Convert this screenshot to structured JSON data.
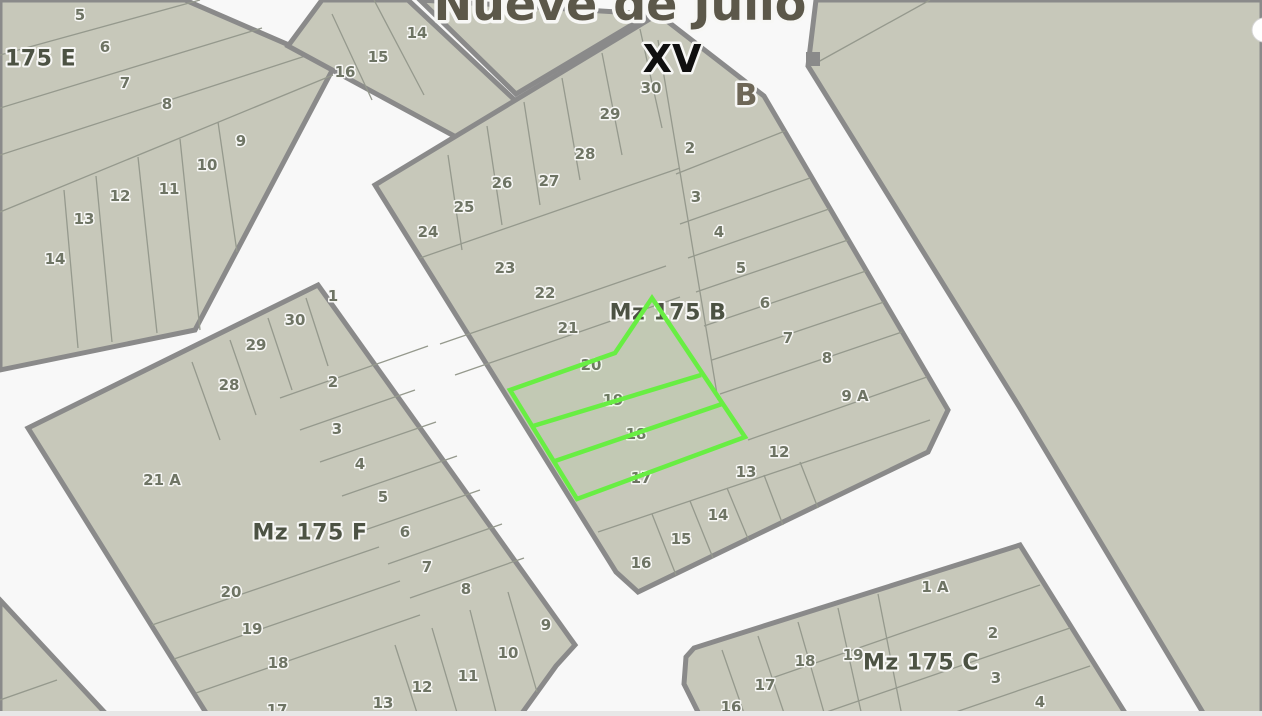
{
  "map": {
    "width": 1262,
    "height": 716,
    "road_color": "#f8f8f8",
    "block_fill": "#c7c8ba",
    "block_border": "#8a8a8a",
    "parcel_line_color": "#95998d",
    "number_color": "#6e7464",
    "label_color": "#4c5243",
    "halo_color": "#f7f7f5",
    "highlight_color": "#68ee43",
    "bottom_strip_color": "#e7e7e7"
  },
  "street_title": {
    "text": "Nueve de Julio",
    "x": 620,
    "y": 20,
    "size": 46,
    "color": "#5c584a"
  },
  "section_label": {
    "text": "XV",
    "x": 672,
    "y": 72,
    "size": 38,
    "color": "#0f0f0f"
  },
  "street_letter": {
    "text": "B",
    "x": 746,
    "y": 105,
    "size": 30,
    "color": "#6e6757"
  },
  "blocks": [
    {
      "id": "175-e",
      "label": "175 E",
      "label_x": 5,
      "label_y": 59,
      "label_anchor": "start",
      "points": [
        [
          0,
          0
        ],
        [
          185,
          0
        ],
        [
          335,
          65
        ],
        [
          195,
          330
        ],
        [
          0,
          370
        ]
      ],
      "lines": [
        [
          0,
          55,
          200,
          0
        ],
        [
          0,
          108,
          262,
          28
        ],
        [
          0,
          155,
          330,
          48
        ],
        [
          0,
          212,
          333,
          75
        ],
        [
          64,
          190,
          78,
          348
        ],
        [
          96,
          176,
          112,
          342
        ],
        [
          138,
          157,
          157,
          333
        ],
        [
          180,
          139,
          200,
          330
        ],
        [
          218,
          122,
          237,
          252
        ]
      ],
      "numbers": [
        [
          "5",
          80,
          15
        ],
        [
          "6",
          105,
          47
        ],
        [
          "7",
          125,
          83
        ],
        [
          "8",
          167,
          104
        ],
        [
          "9",
          241,
          141
        ],
        [
          "10",
          207,
          165
        ],
        [
          "11",
          169,
          189
        ],
        [
          "12",
          120,
          196
        ],
        [
          "13",
          84,
          219
        ],
        [
          "14",
          55,
          259
        ]
      ]
    },
    {
      "id": "north-center",
      "points": [
        [
          322,
          0
        ],
        [
          408,
          0
        ],
        [
          520,
          105
        ],
        [
          480,
          150
        ],
        [
          288,
          46
        ]
      ],
      "lines": [
        [
          332,
          14,
          372,
          100
        ],
        [
          374,
          0,
          424,
          95
        ]
      ],
      "numbers": [
        [
          "14",
          417,
          33
        ],
        [
          "15",
          378,
          57
        ],
        [
          "16",
          345,
          72
        ]
      ]
    },
    {
      "id": "north-sliver",
      "points": [
        [
          420,
          0
        ],
        [
          650,
          14
        ],
        [
          516,
          94
        ]
      ],
      "lines": [],
      "numbers": []
    },
    {
      "id": "mz-175-b",
      "label": "Mz 175 B",
      "label_x": 668,
      "label_y": 313,
      "points": [
        [
          658,
          14
        ],
        [
          764,
          96
        ],
        [
          948,
          410
        ],
        [
          928,
          452
        ],
        [
          638,
          592
        ],
        [
          616,
          572
        ],
        [
          375,
          185
        ]
      ],
      "lines": [
        [
          658,
          40,
          718,
          400
        ],
        [
          676,
          174,
          785,
          131
        ],
        [
          680,
          224,
          810,
          178
        ],
        [
          688,
          258,
          829,
          209
        ],
        [
          696,
          292,
          848,
          240
        ],
        [
          704,
          326,
          866,
          271
        ],
        [
          712,
          360,
          884,
          302
        ],
        [
          720,
          394,
          902,
          332
        ],
        [
          748,
          440,
          927,
          377
        ],
        [
          448,
          155,
          462,
          250
        ],
        [
          487,
          126,
          502,
          225
        ],
        [
          524,
          102,
          540,
          205
        ],
        [
          562,
          78,
          580,
          180
        ],
        [
          602,
          53,
          622,
          155
        ],
        [
          640,
          29,
          662,
          128
        ],
        [
          420,
          258,
          680,
          168
        ],
        [
          440,
          344,
          666,
          266
        ],
        [
          455,
          375,
          680,
          297
        ],
        [
          598,
          532,
          930,
          420
        ],
        [
          652,
          514,
          676,
          575
        ],
        [
          690,
          501,
          713,
          558
        ],
        [
          727,
          488,
          749,
          541
        ],
        [
          764,
          475,
          783,
          525
        ],
        [
          800,
          462,
          818,
          508
        ]
      ],
      "numbers": [
        [
          "30",
          651,
          88
        ],
        [
          "29",
          610,
          114
        ],
        [
          "28",
          585,
          154
        ],
        [
          "27",
          549,
          181
        ],
        [
          "26",
          502,
          183
        ],
        [
          "25",
          464,
          207
        ],
        [
          "24",
          428,
          232
        ],
        [
          "23",
          505,
          268
        ],
        [
          "22",
          545,
          293
        ],
        [
          "21",
          568,
          328
        ],
        [
          "20",
          591,
          365
        ],
        [
          "19",
          613,
          400
        ],
        [
          "18",
          636,
          434
        ],
        [
          "17",
          641,
          478
        ],
        [
          "16",
          641,
          563
        ],
        [
          "15",
          681,
          539
        ],
        [
          "14",
          718,
          515
        ],
        [
          "13",
          746,
          472
        ],
        [
          "12",
          779,
          452
        ],
        [
          "2",
          690,
          148
        ],
        [
          "3",
          696,
          197
        ],
        [
          "4",
          719,
          232
        ],
        [
          "5",
          741,
          268
        ],
        [
          "6",
          765,
          303
        ],
        [
          "7",
          788,
          338
        ],
        [
          "8",
          827,
          358
        ],
        [
          "9 A",
          855,
          396
        ]
      ]
    },
    {
      "id": "mz-175-f",
      "label": "Mz 175 F",
      "label_x": 310,
      "label_y": 533,
      "points": [
        [
          318,
          285
        ],
        [
          575,
          645
        ],
        [
          556,
          666
        ],
        [
          520,
          716
        ],
        [
          208,
          716
        ],
        [
          28,
          428
        ]
      ],
      "lines": [
        [
          306,
          298,
          328,
          366
        ],
        [
          268,
          318,
          292,
          390
        ],
        [
          230,
          340,
          256,
          415
        ],
        [
          192,
          362,
          220,
          440
        ],
        [
          280,
          398,
          428,
          346
        ],
        [
          300,
          430,
          415,
          390
        ],
        [
          320,
          462,
          436,
          422
        ],
        [
          342,
          496,
          457,
          456
        ],
        [
          365,
          530,
          480,
          490
        ],
        [
          388,
          564,
          502,
          524
        ],
        [
          410,
          598,
          524,
          558
        ],
        [
          152,
          625,
          379,
          547
        ],
        [
          174,
          659,
          400,
          581
        ],
        [
          196,
          693,
          420,
          615
        ],
        [
          395,
          645,
          418,
          716
        ],
        [
          432,
          628,
          458,
          716
        ],
        [
          470,
          610,
          497,
          716
        ],
        [
          508,
          592,
          537,
          692
        ]
      ],
      "numbers": [
        [
          "1",
          333,
          296
        ],
        [
          "30",
          295,
          320
        ],
        [
          "29",
          256,
          345
        ],
        [
          "28",
          229,
          385
        ],
        [
          "2",
          333,
          382
        ],
        [
          "3",
          337,
          429
        ],
        [
          "4",
          360,
          464
        ],
        [
          "5",
          383,
          497
        ],
        [
          "6",
          405,
          532
        ],
        [
          "7",
          427,
          567
        ],
        [
          "8",
          466,
          589
        ],
        [
          "9",
          546,
          625
        ],
        [
          "10",
          508,
          653
        ],
        [
          "11",
          468,
          676
        ],
        [
          "12",
          422,
          687
        ],
        [
          "13",
          383,
          703
        ],
        [
          "21 A",
          162,
          480
        ],
        [
          "20",
          231,
          592
        ],
        [
          "19",
          252,
          629
        ],
        [
          "18",
          278,
          663
        ],
        [
          "17",
          277,
          710
        ]
      ]
    },
    {
      "id": "mz-175-c",
      "label": "Mz 175 C",
      "label_x": 921,
      "label_y": 663,
      "points": [
        [
          1020,
          545
        ],
        [
          1127,
          716
        ],
        [
          700,
          716
        ],
        [
          684,
          684
        ],
        [
          686,
          657
        ],
        [
          694,
          648
        ]
      ],
      "lines": [
        [
          772,
          678,
          1040,
          585
        ],
        [
          815,
          716,
          1070,
          628
        ],
        [
          950,
          714,
          1090,
          666
        ],
        [
          722,
          650,
          745,
          716
        ],
        [
          758,
          636,
          785,
          716
        ],
        [
          798,
          622,
          825,
          716
        ],
        [
          838,
          608,
          862,
          716
        ],
        [
          878,
          594,
          902,
          716
        ]
      ],
      "numbers": [
        [
          "1 A",
          935,
          587
        ],
        [
          "2",
          993,
          633
        ],
        [
          "3",
          996,
          678
        ],
        [
          "4",
          1040,
          702
        ],
        [
          "19",
          853,
          655
        ],
        [
          "18",
          805,
          661
        ],
        [
          "17",
          765,
          685
        ],
        [
          "16",
          731,
          707
        ]
      ]
    },
    {
      "id": "east-large",
      "points": [
        [
          816,
          0
        ],
        [
          1262,
          0
        ],
        [
          1262,
          716
        ],
        [
          1205,
          716
        ],
        [
          1020,
          408
        ],
        [
          808,
          66
        ]
      ],
      "lines": [
        [
          930,
          0,
          818,
          62
        ]
      ],
      "numbers": []
    },
    {
      "id": "southwest-corner",
      "points": [
        [
          0,
          600
        ],
        [
          108,
          716
        ],
        [
          0,
          716
        ]
      ],
      "lines": [
        [
          0,
          700,
          57,
          680
        ]
      ],
      "numbers": []
    }
  ],
  "highlight": {
    "parcels": "18, 19, 20",
    "outline": [
      [
        510,
        390
      ],
      [
        615,
        353
      ],
      [
        652,
        298
      ],
      [
        745,
        437
      ],
      [
        577,
        499
      ]
    ],
    "dividers": [
      [
        533,
        426,
        701,
        375
      ],
      [
        555,
        461,
        722,
        404
      ]
    ]
  }
}
